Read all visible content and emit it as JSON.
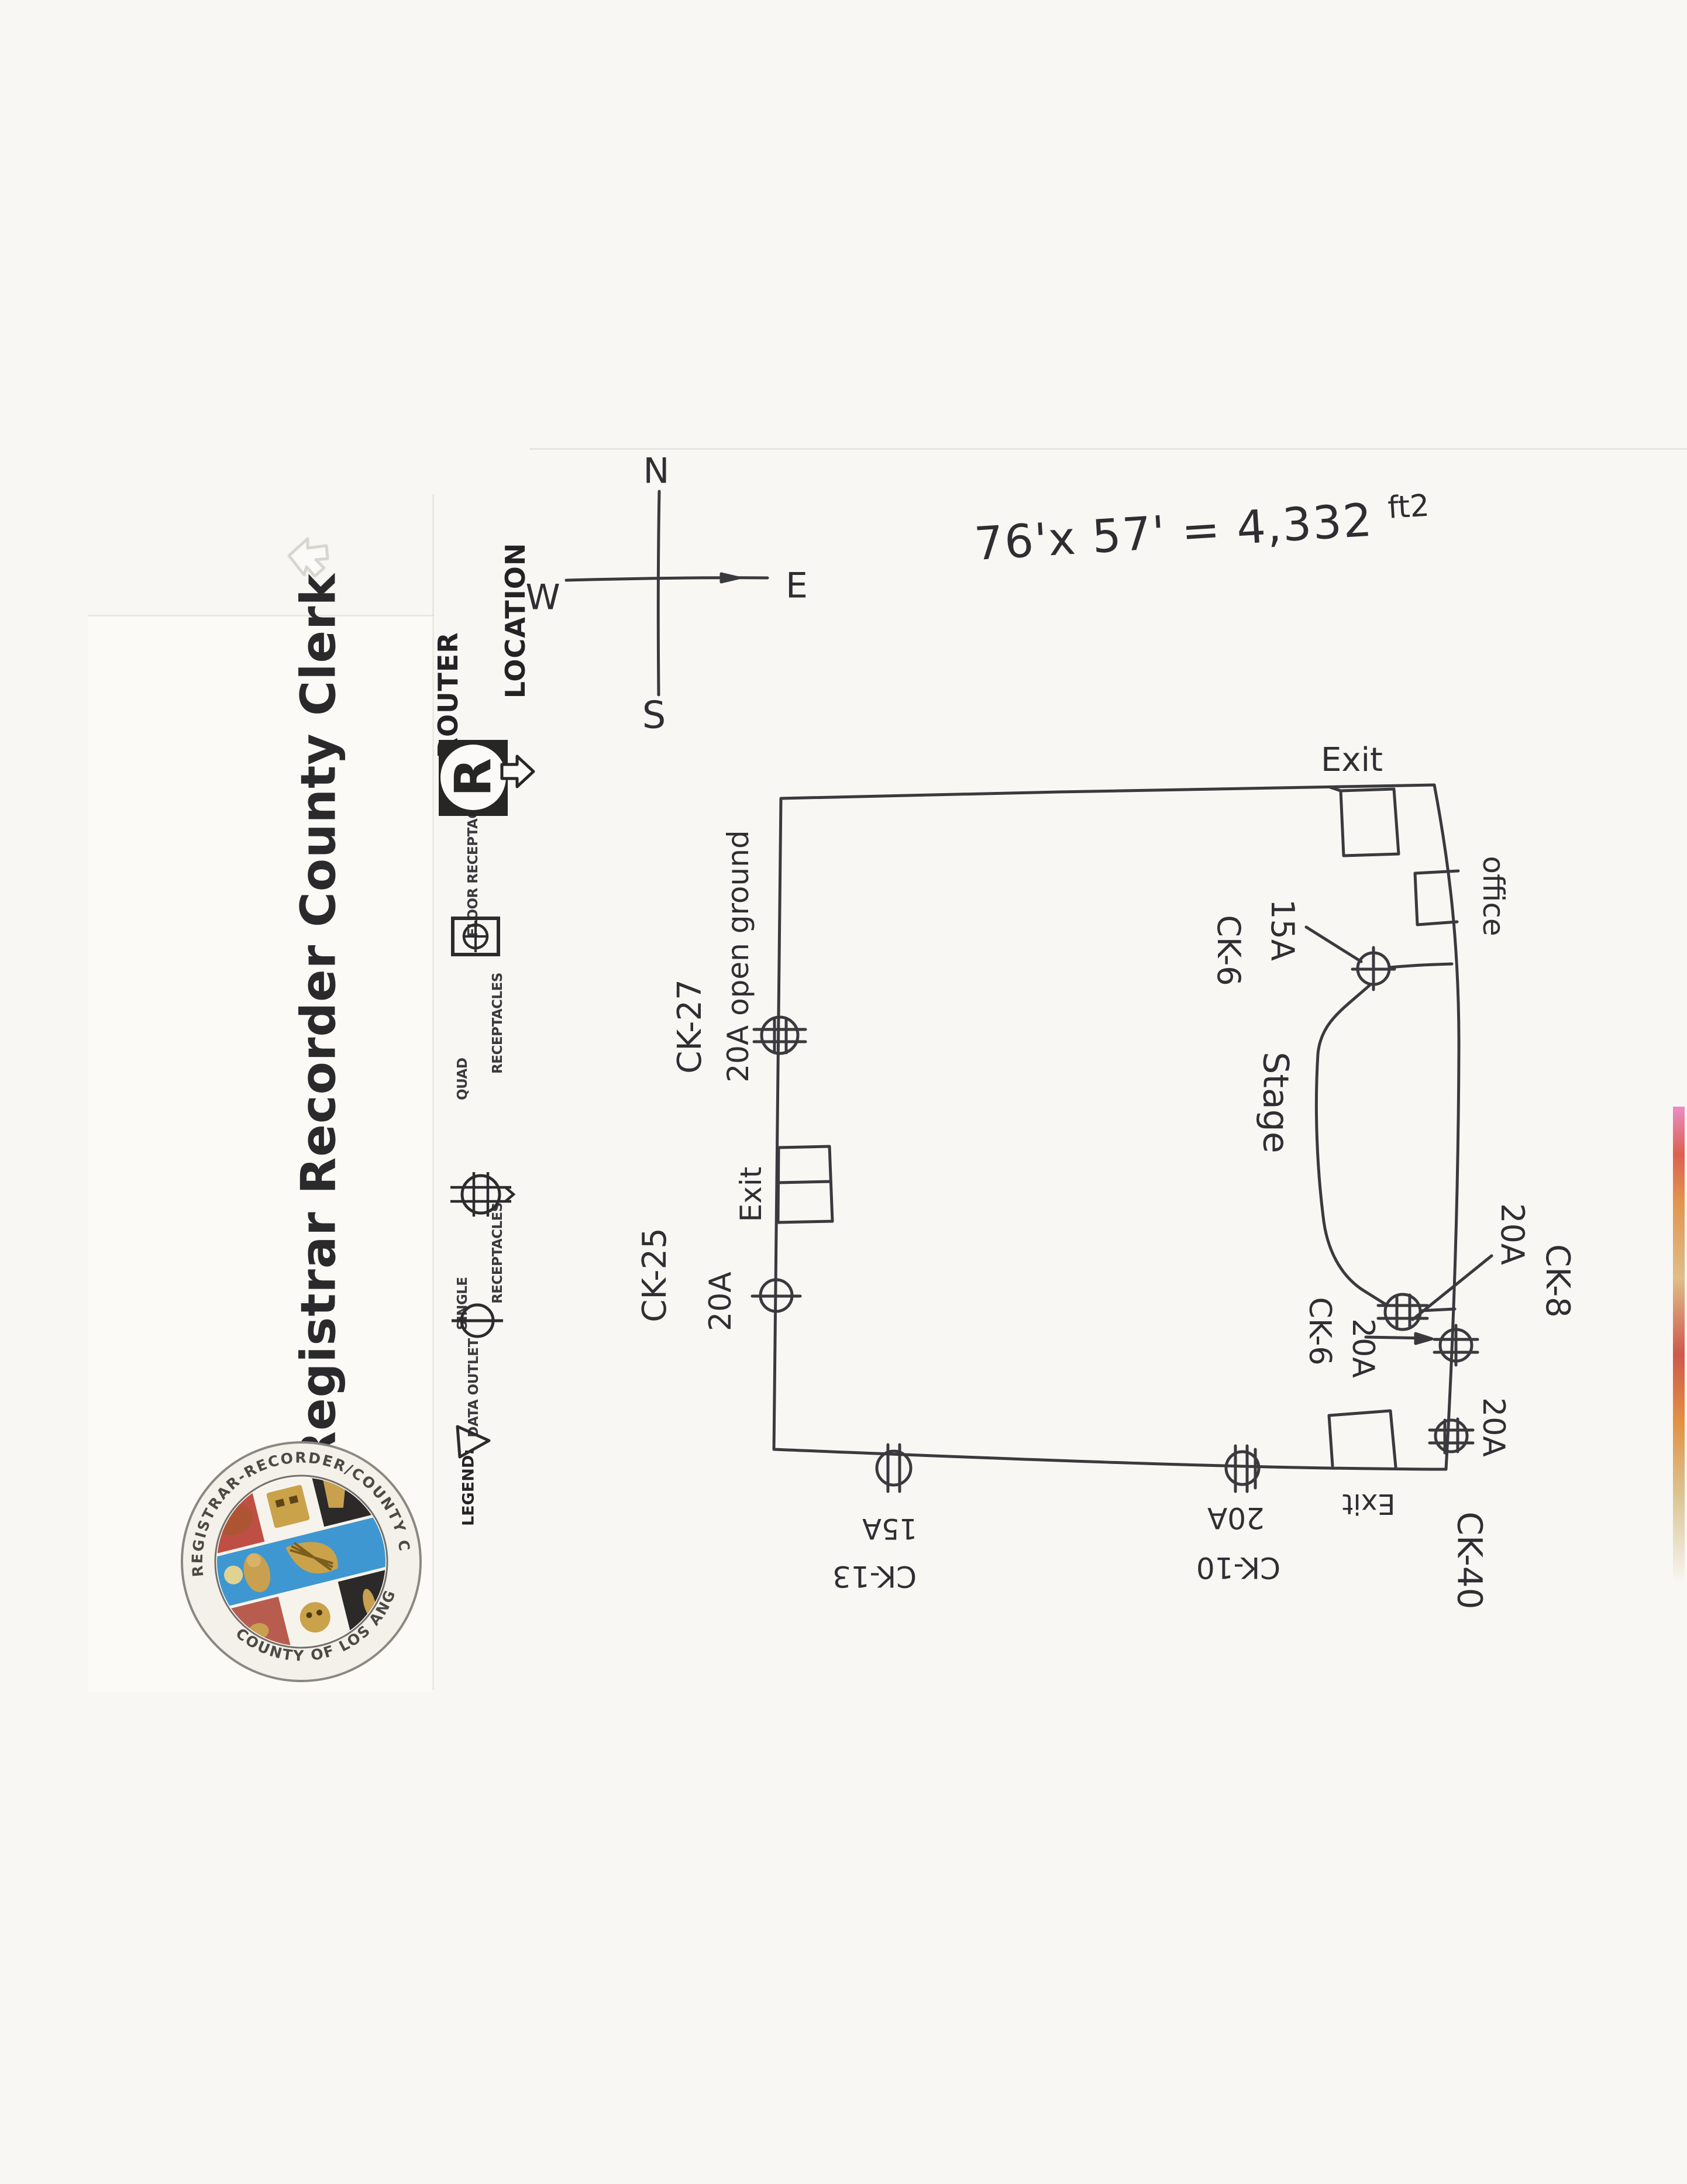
{
  "letterhead": {
    "title": "Registrar Recorder County Clerk"
  },
  "seal": {
    "ring_text_top": "REGISTRAR-RECORDER/COUNTY CLERK",
    "ring_text_bottom": "COUNTY OF LOS ANGELES · CALIFORNIA",
    "colors": {
      "red": "#bf4f44",
      "blue": "#3e97d1",
      "black": "#2b2a28",
      "gold": "#b08a3c",
      "paper": "#f4f1ea"
    }
  },
  "legend": {
    "heading": "LEGEND:",
    "items": [
      {
        "name": "data-outlet",
        "line1": "DATA OUTLET",
        "line2": "",
        "symbol": "triangle"
      },
      {
        "name": "single-receptacles",
        "line1": "SINGLE",
        "line2": "RECEPTACLES",
        "symbol": "single-receptacle"
      },
      {
        "name": "quad-receptacles",
        "line1": "QUAD",
        "line2": "RECEPTACLES",
        "symbol": "quad-receptacle"
      },
      {
        "name": "floor-receptacles",
        "line1": "FLOOR RECEPTACLES",
        "line2": "",
        "symbol": "floor-receptacle"
      },
      {
        "name": "router-location",
        "line1": "ROUTER",
        "line2": "LOCATION",
        "symbol": "router-r"
      }
    ]
  },
  "compass": {
    "n": "N",
    "s": "S",
    "w": "W",
    "e": "E"
  },
  "notes": {
    "dimension": "76'x 57' = 4,332",
    "dimension_unit": "ft2"
  },
  "plan": {
    "labels": {
      "exit_top": "Exit",
      "office": "office",
      "amp15_top": "15A",
      "ck6_top": "CK-6",
      "stage": "Stage",
      "ck8": "CK-8",
      "amp20_ck8": "20A",
      "ck6_stage": "CK-6",
      "amp20_ck6": "20A",
      "amp20_corner": "20A",
      "ck40": "CK-40",
      "ck27": "CK-27",
      "open_ground": "20A open ground",
      "exit_left": "Exit",
      "ck25": "CK-25",
      "amp20_ck25": "20A",
      "amp15_ck13": "15A",
      "ck13": "CK-13",
      "amp20_ck10": "20A",
      "ck10": "CK-10",
      "exit_bottom": "Exit"
    }
  }
}
